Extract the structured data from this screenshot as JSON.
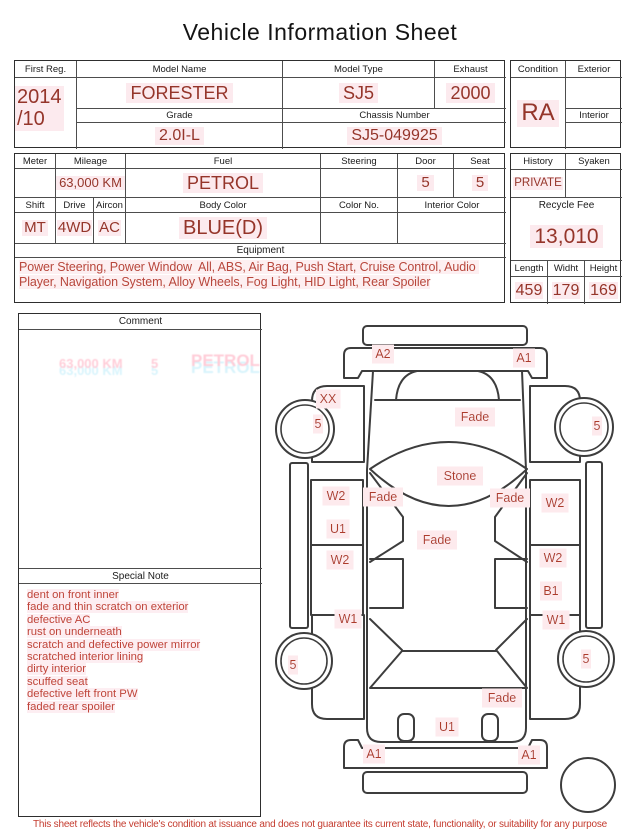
{
  "title": "Vehicle Information Sheet",
  "colors": {
    "value_red": "#95352a",
    "note_red": "#bf4439",
    "label_red": "#ad3a2b",
    "highlight_pink": "#fceaee",
    "line_dark": "#3d3d3d"
  },
  "table1": {
    "first_reg_label": "First Reg.",
    "first_reg_line1": "2014",
    "first_reg_line2": "/10",
    "model_name_label": "Model Name",
    "model_name": "FORESTER",
    "model_type_label": "Model Type",
    "model_type": "SJ5",
    "exhaust_label": "Exhaust",
    "exhaust": "2000",
    "grade_label": "Grade",
    "grade": "2.0I-L",
    "chassis_label": "Chassis Number",
    "chassis": "SJ5-049925",
    "condition_label": "Condition",
    "condition": "RA",
    "exterior_label": "Exterior",
    "exterior": "",
    "interior_label": "Interior",
    "interior": ""
  },
  "table2": {
    "meter_label": "Meter",
    "meter": "",
    "mileage_label": "Mileage",
    "mileage": "63,000 KM",
    "fuel_label": "Fuel",
    "fuel": "PETROL",
    "steering_label": "Steering",
    "steering": "",
    "door_label": "Door",
    "door": "5",
    "seat_label": "Seat",
    "seat": "5",
    "shift_label": "Shift",
    "shift": "MT",
    "drive_label": "Drive",
    "drive": "4WD",
    "aircon_label": "Aircon",
    "aircon": "AC",
    "body_color_label": "Body Color",
    "body_color": "BLUE(D)",
    "color_no_label": "Color No.",
    "color_no": "",
    "interior_color_label": "Interior Color",
    "interior_color": "",
    "equipment_label": "Equipment",
    "equipment": "Power Steering, Power Window  All, ABS, Air Bag, Push Start, Cruise Control, Audio Player, Navigation System, Alloy Wheels, Fog Light, HID Light, Rear Spoiler",
    "history_label": "History",
    "history": "PRIVATE",
    "syaken_label": "Syaken",
    "syaken": "",
    "recycle_fee_label": "Recycle Fee",
    "recycle_fee": "13,010",
    "length_label": "Length",
    "length": "459",
    "width_label": "Widht",
    "width": "179",
    "height_label": "Height",
    "height": "169"
  },
  "comment": {
    "header": "Comment",
    "ghosts": [
      "63,000 KM",
      "5",
      "PETROL"
    ]
  },
  "special_note": {
    "header": "Special Note",
    "lines": [
      "dent on front inner",
      "fade and thin scratch on exterior",
      "defective AC",
      "rust on underneath",
      "scratch and defective power mirror",
      "scratched interior lining",
      "dirty interior",
      "scuffed seat",
      "defective left front PW",
      "faded rear spoiler"
    ]
  },
  "diagram": {
    "labels": [
      {
        "text": "A2"
      },
      {
        "text": "A1"
      },
      {
        "text": "XX"
      },
      {
        "text": "5"
      },
      {
        "text": "Fade"
      },
      {
        "text": "5"
      },
      {
        "text": "Stone"
      },
      {
        "text": "Fade"
      },
      {
        "text": "Fade"
      },
      {
        "text": "W2"
      },
      {
        "text": "W2"
      },
      {
        "text": "U1"
      },
      {
        "text": "Fade"
      },
      {
        "text": "W2"
      },
      {
        "text": "W2"
      },
      {
        "text": "B1"
      },
      {
        "text": "W1"
      },
      {
        "text": "W1"
      },
      {
        "text": "5"
      },
      {
        "text": "5"
      },
      {
        "text": "Fade"
      },
      {
        "text": "U1"
      },
      {
        "text": "A1"
      },
      {
        "text": "A1"
      }
    ]
  },
  "disclaimer": "This sheet reflects the vehicle's condition at issuance and does not guarantee its current state, functionality, or suitability for any purpose"
}
